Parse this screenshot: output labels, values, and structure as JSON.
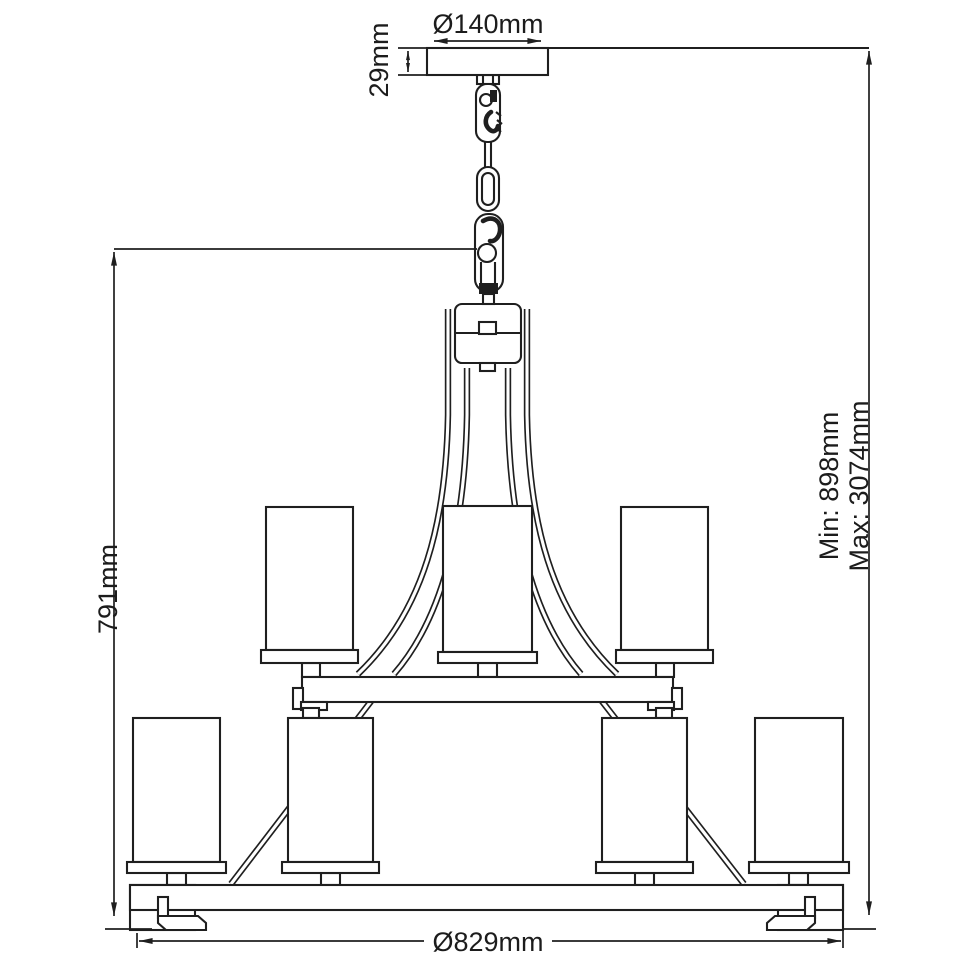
{
  "diagram": {
    "colors": {
      "line": "#1f1f1f",
      "background": "#ffffff"
    },
    "labels": {
      "canopy_diameter": "Ø140mm",
      "canopy_height": "29mm",
      "body_height": "791mm",
      "suspension_min": "Min: 898mm",
      "suspension_max": "Max: 3074mm",
      "body_diameter": "Ø829mm"
    }
  }
}
